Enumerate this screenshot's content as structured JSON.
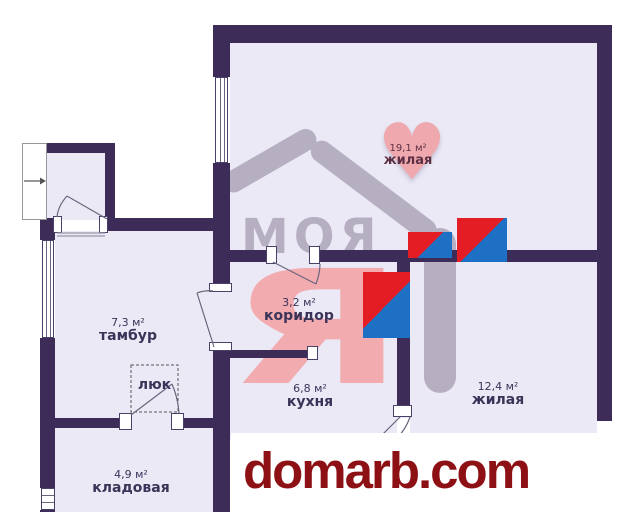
{
  "plan": {
    "rooms": [
      {
        "area": "19,1 м²",
        "name": "жилая"
      },
      {
        "area": "3,2 м²",
        "name": "коридор"
      },
      {
        "area": "7,3 м²",
        "name": "тамбур"
      },
      {
        "area": "6,8 м²",
        "name": "кухня"
      },
      {
        "area": "12,4 м²",
        "name": "жилая"
      },
      {
        "area": "4,9 м²",
        "name": "кладовая"
      }
    ],
    "hatch_label": "люк"
  },
  "watermark": {
    "logo_text": "МОЯ",
    "logo_letter": "Я"
  },
  "footer": {
    "site": "domarb.com"
  },
  "icons": {
    "heart": "♥"
  },
  "colors": {
    "wall": "#3d2c57",
    "room_fill": "#ebe9f6",
    "marker_red": "#e41d25",
    "marker_blue": "#1e70c5",
    "heart_pink": "#efa9ae",
    "watermark_gray": "#b6afc2",
    "watermark_pink": "#f2abaf",
    "footer_red": "#8d1114",
    "label_text": "#3b3358"
  }
}
